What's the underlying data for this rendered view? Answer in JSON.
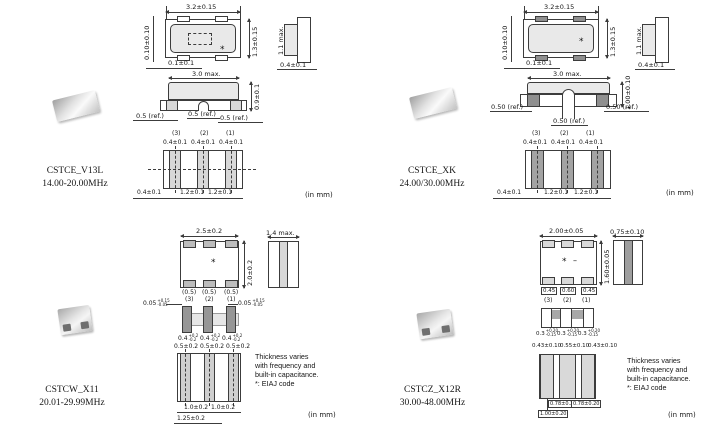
{
  "in_mm": "(in mm)",
  "note": {
    "lines": [
      "Thickness varies",
      "with frequency and",
      "built-in capacitance.",
      "*: EIAJ code"
    ]
  },
  "q1": {
    "part": "CSTCE_V13L",
    "freq": "14.00-20.00MHz",
    "top": {
      "width": "3.2±0.15",
      "height": "1.3±0.15",
      "corner_v": "0.10±0.10",
      "corner_h": "0.1±0.1",
      "mark": "*"
    },
    "side": {
      "height": "1.1 max.",
      "terminal": "0.4±0.1"
    },
    "front": {
      "width": "3.0 max.",
      "height": "0.9±0.1",
      "ref_left": "0.5 (ref.)",
      "ref_center": "0.5 (ref.)",
      "ref_right": "0.5 (ref.)"
    },
    "pins": {
      "p3": "(3)",
      "p2": "(2)",
      "p1": "(1)"
    },
    "pads": {
      "w3": "0.4±0.1",
      "w2": "0.4±0.1",
      "w1": "0.4±0.1"
    },
    "bottom": {
      "edge": "0.4±0.1",
      "pitch_a": "1.2±0.1",
      "pitch_b": "1.2±0.1"
    }
  },
  "q2": {
    "part": "CSTCE_XK",
    "freq": "24.00/30.00MHz",
    "top": {
      "width": "3.2±0.15",
      "height": "1.3±0.15",
      "corner_v": "0.10±0.10",
      "corner_h": "0.1±0.1",
      "mark": "*"
    },
    "side": {
      "height": "1.1 max.",
      "terminal": "0.4±0.1"
    },
    "front": {
      "width": "3.0 max.",
      "height": "1.00±0.10",
      "ref_left": "0.50 (ref.)",
      "ref_center": "0.50 (ref.)",
      "ref_right": "0.50 (ref.)"
    },
    "pins": {
      "p3": "(3)",
      "p2": "(2)",
      "p1": "(1)"
    },
    "pads": {
      "w3": "0.4±0.1",
      "w2": "0.4±0.1",
      "w1": "0.4±0.1"
    },
    "bottom": {
      "edge": "0.4±0.1",
      "pitch_a": "1.2±0.1",
      "pitch_b": "1.2±0.1"
    }
  },
  "q3": {
    "part": "CSTCW_X11",
    "freq": "20.01-29.99MHz",
    "top": {
      "width": "2.5±0.2",
      "height": "2.0±0.2",
      "mark": "*",
      "pad_w3": "(0.5)",
      "pad_w2": "(0.5)",
      "pad_w1": "(0.5)"
    },
    "pins": {
      "p3": "(3)",
      "p2": "(2)",
      "p1": "(1)"
    },
    "side": {
      "width": "1.4 max."
    },
    "mid": {
      "gap_base": "0.05",
      "gap_plus": "+0.15",
      "gap_minus": "-0.05",
      "el_base": "0.4",
      "el_plus": "+0.2",
      "el_minus": "-0.2",
      "w3": "0.5±0.2",
      "w2": "0.5±0.2",
      "w1": "0.5±0.2"
    },
    "bottom": {
      "pitch_a": "1.0±0.2",
      "pitch_b": "1.0±0.2",
      "overall": "1.25±0.2"
    }
  },
  "q4": {
    "part": "CSTCZ_X12R",
    "freq": "30.00-48.00MHz",
    "top": {
      "width": "2.00±0.05",
      "height": "1.60±0.05",
      "mark": "*",
      "mark2": "–",
      "pad_w3": "0.45",
      "pad_w2": "0.60",
      "pad_w1": "0.45"
    },
    "pins": {
      "p3": "(3)",
      "p2": "(2)",
      "p1": "(1)"
    },
    "side": {
      "width": "0.75±0.10"
    },
    "mid": {
      "el_base": "0.3",
      "el_plus": "+0.20",
      "el_minus": "-0.15",
      "w3": "0.43±0.10",
      "w2": "0.55±0.10",
      "w1": "0.43±0.10"
    },
    "bottom": {
      "pitch_a": "0.78±0.20",
      "pitch_b": "0.78±0.20",
      "overall": "1.00±0.20"
    }
  }
}
